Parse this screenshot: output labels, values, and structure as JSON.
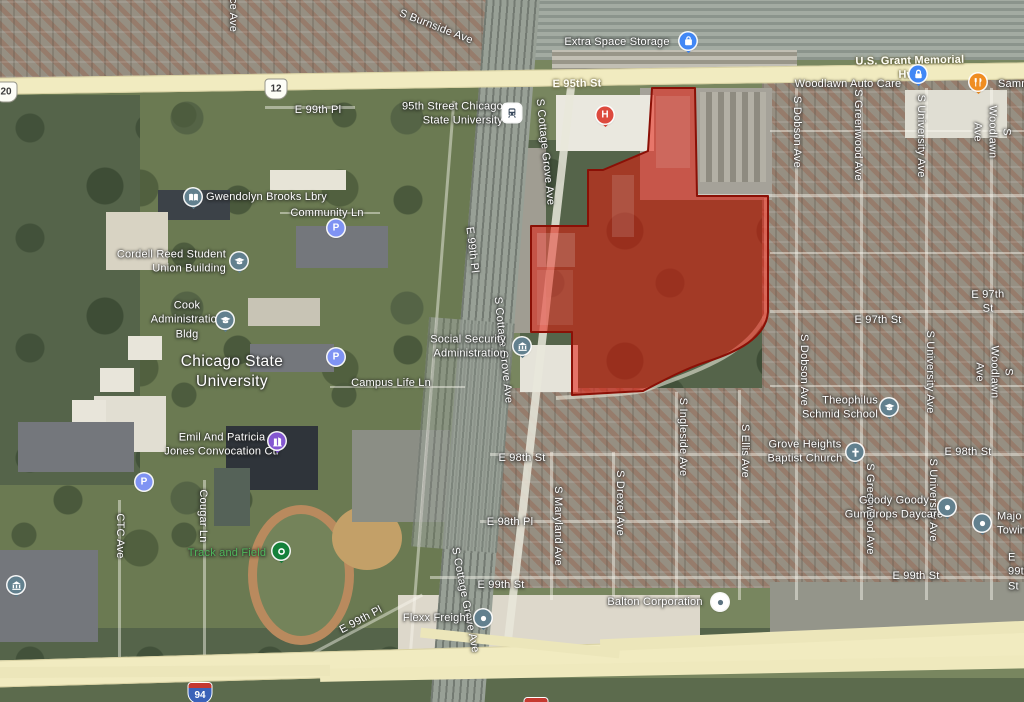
{
  "view": {
    "type": "satellite-map",
    "width": 1024,
    "height": 702
  },
  "highlight": {
    "name": "selected-parcel",
    "path": "M652 88 L695 88 L697 196 L768 196 L768 312 C766 338 737 352 706 362 C685 369 664 380 643 391 L572 395 L572 332 L531 332 L531 226 L588 226 L588 170 L603 170 L648 151 Z",
    "fill": "#e3170a",
    "opacity": 0.55,
    "stroke": "#8a1006"
  },
  "shields": [
    {
      "n": "us-route-20-shield",
      "sys": "us",
      "num": "20",
      "x": 6,
      "y": 92
    },
    {
      "n": "us-route-12-shield",
      "sys": "us",
      "num": "12",
      "x": 276,
      "y": 89
    },
    {
      "n": "i94-shield-left",
      "sys": "i",
      "num": "94",
      "x": 200,
      "y": 693
    },
    {
      "n": "i94-shield-center",
      "sys": "i",
      "num": "94",
      "x": 536,
      "y": 686
    }
  ],
  "street_labels": [
    {
      "n": "s-burnside-ave",
      "t": "S Burnside Ave",
      "x": 436,
      "y": 27,
      "r": 21
    },
    {
      "n": "avenue-fragment",
      "t": "ce Ave",
      "x": 233,
      "y": 15,
      "r": 90
    },
    {
      "n": "e-95th-st",
      "t": "E 95th St",
      "x": 577,
      "y": 84,
      "r": -1,
      "c": "road"
    },
    {
      "n": "us-grant-memorial-hwy",
      "t": "U.S. Grant Memorial Hwy",
      "x": 910,
      "y": 68,
      "r": -1,
      "c": "road"
    },
    {
      "n": "e-99th-pl-nw",
      "t": "E 99th Pl",
      "x": 318,
      "y": 110
    },
    {
      "n": "community-ln",
      "t": "Community Ln",
      "x": 327,
      "y": 213
    },
    {
      "n": "e-99th-pl-rail",
      "t": "E 99th Pl",
      "x": 472,
      "y": 250,
      "r": 83
    },
    {
      "n": "s-cottage-grove-n",
      "t": "S Cottage Grove Ave",
      "x": 545,
      "y": 152,
      "r": 84
    },
    {
      "n": "s-cottage-grove-mid",
      "t": "S Cottage Grove Ave",
      "x": 503,
      "y": 350,
      "r": 84
    },
    {
      "n": "s-cottage-grove-s",
      "t": "S Cottage Grove Ave",
      "x": 465,
      "y": 600,
      "r": 79
    },
    {
      "n": "campus-life-ln",
      "t": "Campus Life Ln",
      "x": 391,
      "y": 383
    },
    {
      "n": "ctc-ave",
      "t": "CTC Ave",
      "x": 120,
      "y": 536,
      "r": 90
    },
    {
      "n": "cougar-ln",
      "t": "Cougar Ln",
      "x": 203,
      "y": 516,
      "r": 90
    },
    {
      "n": "e-99th-pl-sw",
      "t": "E 99th Pl",
      "x": 361,
      "y": 620,
      "r": -28
    },
    {
      "n": "chicago-state-university",
      "t": "Chicago State\nUniversity",
      "x": 232,
      "y": 372,
      "c": "big"
    },
    {
      "n": "e-97th-st-right",
      "t": "E 97th St",
      "x": 988,
      "y": 302,
      "r": -1
    },
    {
      "n": "e-97th-st-mid",
      "t": "E 97th St",
      "x": 878,
      "y": 320
    },
    {
      "n": "s-dobson-ave-n",
      "t": "S Dobson Ave",
      "x": 797,
      "y": 132,
      "r": 90
    },
    {
      "n": "s-dobson-ave-mid",
      "t": "S Dobson Ave",
      "x": 804,
      "y": 370,
      "r": 90
    },
    {
      "n": "s-greenwood-ave-n",
      "t": "S Greenwood Ave",
      "x": 858,
      "y": 135,
      "r": 90
    },
    {
      "n": "s-greenwood-ave-s",
      "t": "S Greenwood Ave",
      "x": 870,
      "y": 509,
      "r": 90
    },
    {
      "n": "s-university-ave-n",
      "t": "S University Ave",
      "x": 921,
      "y": 136,
      "r": 90
    },
    {
      "n": "s-university-ave-mid",
      "t": "S University Ave",
      "x": 930,
      "y": 372,
      "r": 90
    },
    {
      "n": "s-university-ave-s",
      "t": "S University Ave",
      "x": 933,
      "y": 500,
      "r": 90
    },
    {
      "n": "s-woodlawn-ave-n",
      "t": "S Woodlawn Ave",
      "x": 992,
      "y": 132,
      "r": 90
    },
    {
      "n": "s-woodlawn-ave-mid",
      "t": "S Woodlawn Ave",
      "x": 994,
      "y": 372,
      "r": 90
    },
    {
      "n": "e-98th-st-right",
      "t": "E 98th St",
      "x": 968,
      "y": 452
    },
    {
      "n": "e-98th-st-mid",
      "t": "E 98th St",
      "x": 522,
      "y": 458
    },
    {
      "n": "e-98th-pl",
      "t": "E 98th Pl",
      "x": 510,
      "y": 522
    },
    {
      "n": "e-99th-st-mid",
      "t": "E 99th St",
      "x": 501,
      "y": 585
    },
    {
      "n": "e-99th-st-right",
      "t": "E 99th St",
      "x": 916,
      "y": 576
    },
    {
      "n": "e-99th-st-edge",
      "t": "E 99th St",
      "x": 1008,
      "y": 572,
      "a": "w"
    },
    {
      "n": "s-maryland-ave",
      "t": "S Maryland Ave",
      "x": 558,
      "y": 526,
      "r": 90
    },
    {
      "n": "s-drexel-ave",
      "t": "S Drexel Ave",
      "x": 620,
      "y": 503,
      "r": 90
    },
    {
      "n": "s-ingleside-ave",
      "t": "S Ingleside Ave",
      "x": 683,
      "y": 437,
      "r": 90
    },
    {
      "n": "s-ellis-ave",
      "t": "S Ellis Ave",
      "x": 745,
      "y": 451,
      "r": 90
    }
  ],
  "pois": [
    {
      "n": "extra-space-storage",
      "t": "Extra Space Storage",
      "x": 617,
      "y": 42,
      "pin": {
        "g": "bag",
        "col": "#4187f5",
        "x": 688,
        "y": 41,
        "tail": true
      }
    },
    {
      "n": "metra-95th-station",
      "t": "95th Street Chicago\nState University",
      "x": 503,
      "y": 114,
      "a": "e",
      "pin": {
        "g": "train",
        "col": "#ffffff",
        "x": 512,
        "y": 113,
        "shape": "square"
      }
    },
    {
      "n": "woodlawn-auto-care",
      "t": "Woodlawn Auto Care",
      "x": 848,
      "y": 84,
      "pin": {
        "g": "lock",
        "col": "#4187f5",
        "x": 918,
        "y": 74,
        "tail": true
      }
    },
    {
      "n": "sammys-restaurant",
      "t": "Sammy",
      "x": 998,
      "y": 84,
      "a": "w",
      "pin": {
        "g": "fork",
        "col": "#ef8d22",
        "x": 978,
        "y": 82,
        "tail": true
      }
    },
    {
      "n": "gwendolyn-brooks-library",
      "t": "Gwendolyn Brooks Lbry",
      "x": 206,
      "y": 197,
      "a": "w",
      "pin": {
        "g": "book",
        "col": "#62808e",
        "x": 193,
        "y": 197,
        "tail": true
      }
    },
    {
      "n": "cordell-reed-student-union",
      "t": "Cordell Reed Student\nUnion Building",
      "x": 226,
      "y": 262,
      "a": "e",
      "pin": {
        "g": "grad",
        "col": "#62808e",
        "x": 239,
        "y": 261,
        "tail": true
      }
    },
    {
      "n": "cook-administration-bldg",
      "t": "Cook\nAdministration\nBldg",
      "x": 187,
      "y": 320,
      "pin": {
        "g": "grad",
        "col": "#62808e",
        "x": 225,
        "y": 320,
        "tail": true
      }
    },
    {
      "n": "social-security-administration",
      "t": "Social Security\nAdministration",
      "x": 506,
      "y": 347,
      "a": "e",
      "pin": {
        "g": "bank",
        "col": "#62808e",
        "x": 522,
        "y": 346,
        "tail": true
      }
    },
    {
      "n": "jones-convocation-center",
      "t": "Emil And Patricia\nJones Convocation Ctr",
      "x": 222,
      "y": 445,
      "pin": {
        "g": "building",
        "col": "#8457d1",
        "x": 277,
        "y": 441,
        "tail": true
      }
    },
    {
      "n": "track-and-field",
      "t": "Track and Field",
      "x": 227,
      "y": 553,
      "c": "green",
      "pin": {
        "g": "trackdot",
        "col": "#15813b",
        "x": 281,
        "y": 551,
        "tail": true
      }
    },
    {
      "n": "theophilus-schmid-school",
      "t": "Theophilus\nSchmid School",
      "x": 878,
      "y": 408,
      "a": "e",
      "pin": {
        "g": "grad",
        "col": "#62808e",
        "x": 889,
        "y": 407,
        "tail": true
      }
    },
    {
      "n": "grove-heights-baptist-church",
      "t": "Grove Heights\nBaptist Church",
      "x": 805,
      "y": 452,
      "pin": {
        "g": "cross",
        "col": "#62808e",
        "x": 855,
        "y": 452,
        "tail": true
      }
    },
    {
      "n": "goody-goody-gumdrops-daycare",
      "t": "Goody Goody\nGumdrops Daycare",
      "x": 894,
      "y": 508,
      "pin": {
        "g": "dot",
        "col": "#62808e",
        "x": 947,
        "y": 507,
        "tail": true
      }
    },
    {
      "n": "major-towing",
      "t": "Majo\nTowin",
      "x": 997,
      "y": 524,
      "a": "w",
      "pin": {
        "g": "dot",
        "col": "#62808e",
        "x": 982,
        "y": 523,
        "tail": true
      }
    },
    {
      "n": "balton-corporation",
      "t": "Balton Corporation",
      "x": 655,
      "y": 602,
      "pin": {
        "g": "dotdark",
        "col": "#ffffff",
        "x": 720,
        "y": 602,
        "tail": false
      }
    },
    {
      "n": "flexx-freight",
      "t": "Flexx Freight",
      "x": 436,
      "y": 618,
      "pin": {
        "g": "dot",
        "col": "#62808e",
        "x": 483,
        "y": 618,
        "tail": true
      }
    }
  ],
  "pins": [
    {
      "n": "hospital-pin",
      "g": "H",
      "col": "#dd4a3e",
      "x": 605,
      "y": 115,
      "tail": true
    },
    {
      "n": "parking-pin-1",
      "g": "P",
      "col": "#7f93f3",
      "x": 336,
      "y": 228
    },
    {
      "n": "parking-pin-2",
      "g": "P",
      "col": "#7f93f3",
      "x": 336,
      "y": 357
    },
    {
      "n": "parking-pin-3",
      "g": "P",
      "col": "#7f93f3",
      "x": 144,
      "y": 482
    },
    {
      "n": "building-pin",
      "g": "bank",
      "col": "#62808e",
      "x": 16,
      "y": 585,
      "tail": true
    }
  ]
}
